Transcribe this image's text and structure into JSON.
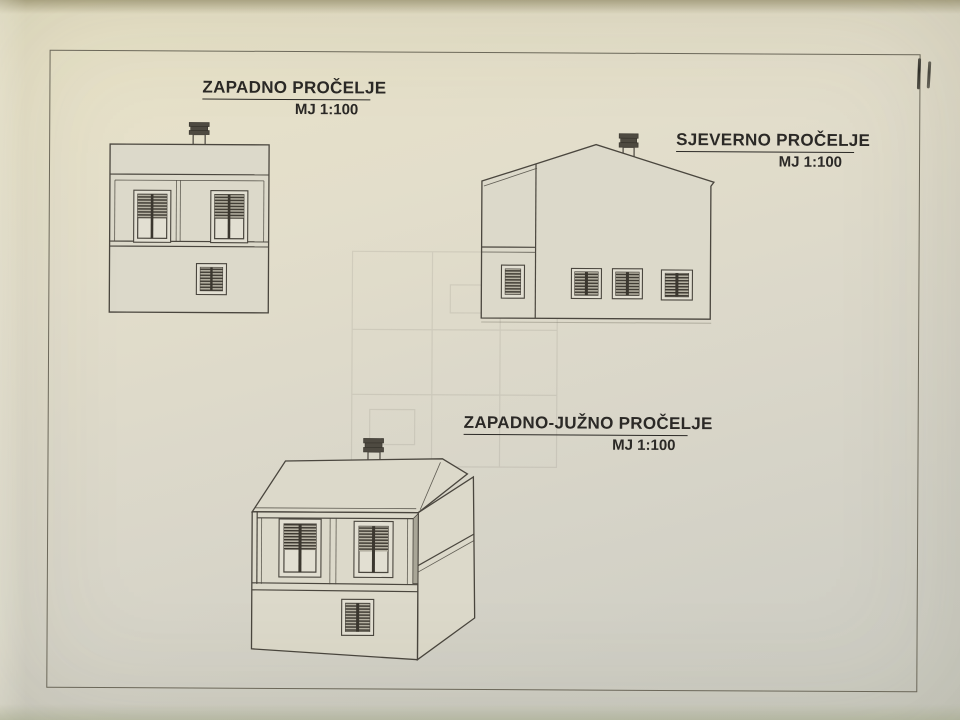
{
  "sheet": {
    "elevations": [
      {
        "title": "ZAPADNO PROČELJE",
        "scale": "MJ 1:100"
      },
      {
        "title": "SJEVERNO PROČELJE",
        "scale": "MJ 1:100"
      },
      {
        "title": "ZAPADNO-JUŽNO PROČELJE",
        "scale": "MJ 1:100"
      }
    ]
  },
  "colors": {
    "frame_line": "#6e6a5c",
    "drawing_line": "#4a463e",
    "louver_dark": "#3b372f",
    "text": "#2b2926",
    "paper_fill": "#dcd9ca",
    "window_frame_fill": "#e2dfd2"
  }
}
